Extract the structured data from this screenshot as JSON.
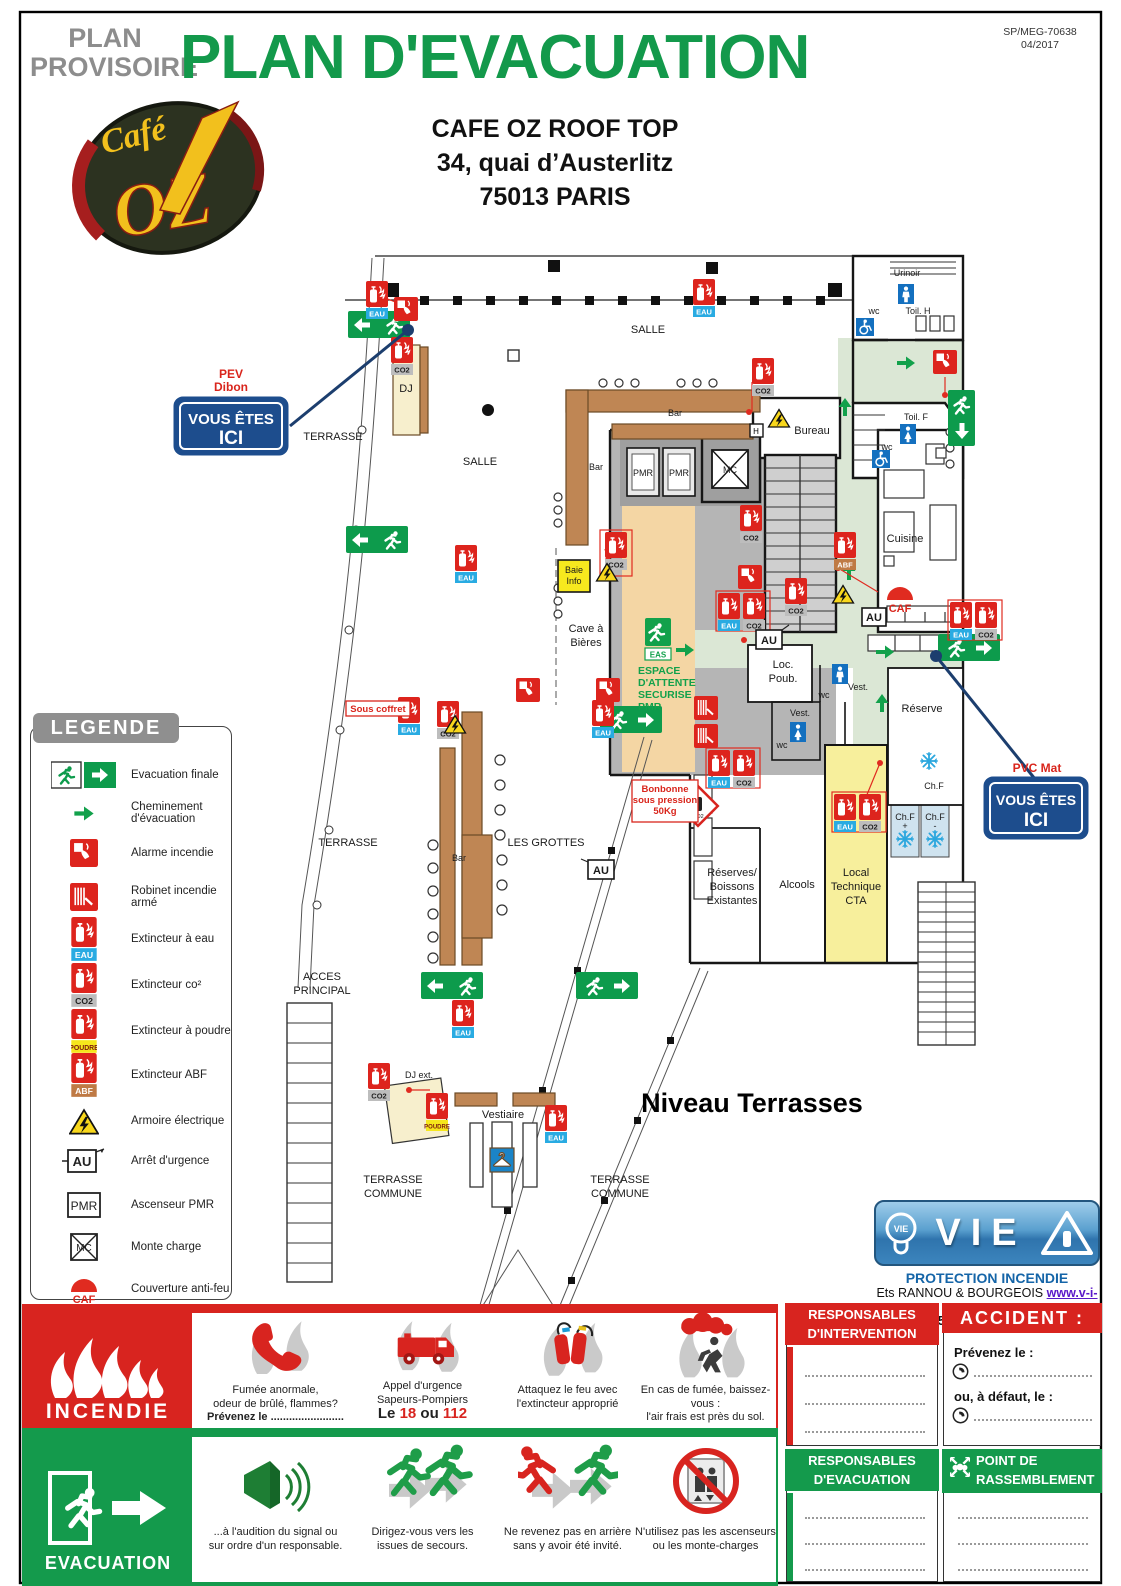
{
  "header": {
    "provisional_line1": "PLAN",
    "provisional_line2": "PROVISOIRE",
    "title": "PLAN D'EVACUATION",
    "ref_line1": "SP/MEG-70638",
    "ref_line2": "04/2017"
  },
  "venue": {
    "name": "CAFE OZ ROOF TOP",
    "address_line1": "34, quai d’Austerlitz",
    "address_line2": "75013 PARIS",
    "logo_cafe": "Café",
    "logo_oz": "OZ"
  },
  "legend": {
    "title": "LEGENDE",
    "items": [
      {
        "label": "Evacuation finale"
      },
      {
        "label": "Cheminement d'évacuation"
      },
      {
        "label": "Alarme incendie"
      },
      {
        "label": "Robinet incendie armé"
      },
      {
        "label": "Extincteur à eau"
      },
      {
        "label": "Extincteur co²"
      },
      {
        "label": "Extincteur à poudre"
      },
      {
        "label": "Extincteur ABF"
      },
      {
        "label": "Armoire électrique"
      },
      {
        "label": "Arrêt d'urgence"
      },
      {
        "label": "Ascenseur PMR"
      },
      {
        "label": "Monte charge"
      },
      {
        "label": "Couverture anti-feu"
      }
    ]
  },
  "plan": {
    "title": "Niveau Terrasses",
    "icon_labels": {
      "eau": "EAU",
      "co2": "CO2",
      "poudre": "POUDRE",
      "abf": "ABF",
      "eas": "EAS",
      "au": "AU",
      "pmr": "PMR",
      "mc": "MC",
      "caf": "CAF",
      "h": "H"
    },
    "labels": {
      "salle": "SALLE",
      "terrasse": "TERRASSE",
      "commune": "COMMUNE",
      "les_grottes": "LES GROTTES",
      "acces_1": "ACCES",
      "acces_2": "PRINCIPAL",
      "bar": "Bar",
      "dj": "DJ",
      "dj_ext": "DJ ext.",
      "vestiaire": "Vestiaire",
      "bureau": "Bureau",
      "urinoir": "Urinoir",
      "toil_h": "Toil. H",
      "toil_f": "Toil. F",
      "wc": "wc",
      "cuisine": "Cuisine",
      "reserve": "Réserve",
      "loc_1": "Loc.",
      "loc_2": "Poub.",
      "vest": "Vest.",
      "cave_1": "Cave à",
      "cave_2": "Bières",
      "baie_1": "Baie",
      "baie_2": "Info",
      "espace_1": "ESPACE",
      "espace_2": "D'ATTENTE",
      "espace_3": "SECURISE",
      "espace_4": "PMR",
      "reserves_1": "Réserves/",
      "reserves_2": "Boissons",
      "reserves_3": "Existantes",
      "alcools": "Alcools",
      "local_1": "Local",
      "local_2": "Technique",
      "local_3": "CTA",
      "chf": "Ch.F",
      "plus": "+",
      "minus": "-",
      "sous_coffret": "Sous coffret",
      "bonbonne_1": "Bonbonne",
      "bonbonne_2": "sous pression",
      "bonbonne_3": "50Kg"
    },
    "markers": {
      "pev_1": "PEV",
      "pev_2": "Dibon",
      "pvc": "PVC Mat",
      "ici_1": "VOUS ÊTES",
      "ici_2": "ICI"
    }
  },
  "incendie": {
    "title": "INCENDIE",
    "item1_l1": "Fumée anormale,",
    "item1_l2": "odeur de brûlé, flammes?",
    "item1_l3": "Prévenez le ........................",
    "item2_l1": "Appel d'urgence",
    "item2_l2": "Sapeurs-Pompiers",
    "item2_l3a": "Le ",
    "item2_l3b": "18",
    "item2_l3c": " ou ",
    "item2_l3d": "112",
    "item3_l1": "Attaquez le feu avec",
    "item3_l2": "l'extincteur approprié",
    "item4_l1": "En cas de fumée, baissez-vous :",
    "item4_l2": "l'air frais est près du sol."
  },
  "evacuation": {
    "title": "EVACUATION",
    "item1_l1": "...à l'audition du signal ou",
    "item1_l2": "sur ordre d'un responsable.",
    "item2_l1": "Dirigez-vous vers les",
    "item2_l2": "issues de secours.",
    "item3_l1": "Ne revenez pas en arrière",
    "item3_l2": "sans y avoir été invité.",
    "item4_l1": "N'utilisez pas les ascenseurs",
    "item4_l2": "ou les monte-charges"
  },
  "panels": {
    "intervention_1": "RESPONSABLES",
    "intervention_2": "D'INTERVENTION",
    "accident": "ACCIDENT :",
    "prevenez": "Prévenez le :",
    "ou_defaut": "ou, à défaut, le :",
    "evac_1": "RESPONSABLES",
    "evac_2": "D'EVACUATION",
    "point_1": "POINT DE",
    "point_2": "RASSEMBLEMENT"
  },
  "vie": {
    "brand": "VIE",
    "tagline": "PROTECTION INCENDIE",
    "company": "Ets RANNOU & BOURGEOIS",
    "url": "www.v-i-e.eu",
    "tel": "Tel: 01 48 57 84 95",
    "port": "Port: 06 24 06 49 93"
  }
}
